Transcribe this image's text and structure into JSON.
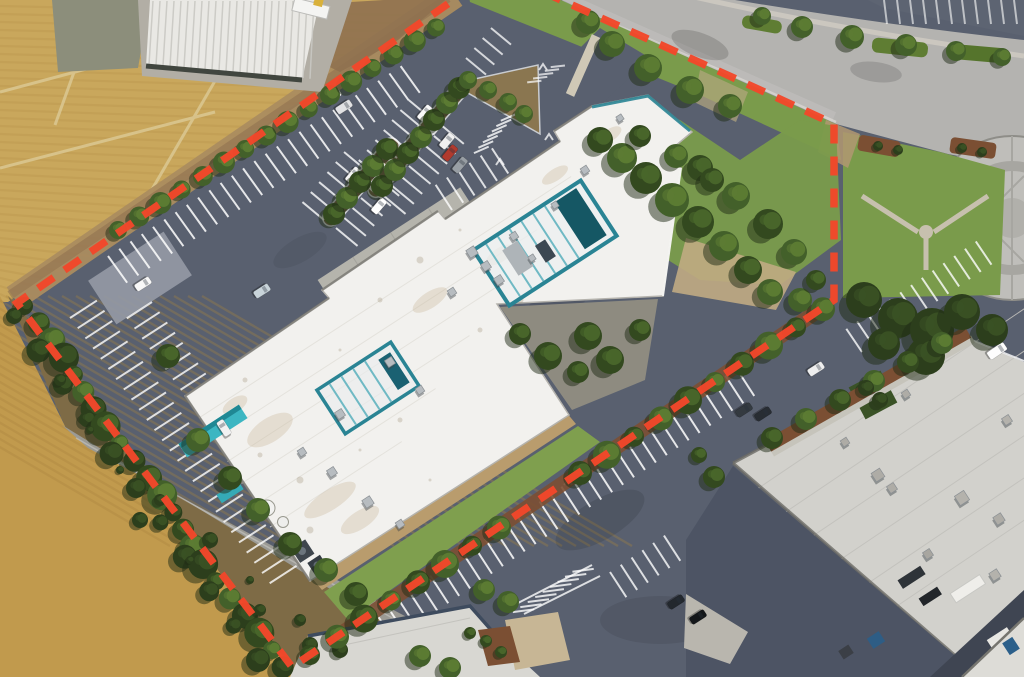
{
  "meta": {
    "image_type": "satellite-aerial-photograph",
    "description": "Overhead aerial view of a suburban commercial office property outlined with a red dashed property-boundary overlay; farm fields to the west, a curving street with landscaped median and circular plaza to the northeast, and a neighboring industrial building to the southeast.",
    "width_px": 1024,
    "height_px": 677,
    "visible_text": "none"
  },
  "annotation": {
    "name": "property-boundary",
    "style": "dashed polygon overlay",
    "color": "#f2472a",
    "dash_length_px": 19,
    "dash_gap_px": 13,
    "stroke_width_px": 7.5
  },
  "palette": {
    "asphalt": "#59606f",
    "asphalt-dark": "#4d5464",
    "road": "#b4b3b0",
    "road-light": "#c3c2bf",
    "rural-road": "#9b9a94",
    "field-gold": "#c9a75c",
    "field-gold-low": "#c19a4d",
    "field-stripe": "#b18c45",
    "scrub": "#7e6b46",
    "dirt": "#ab8c5f",
    "dirt-dark": "#8f7150",
    "lawn": "#7a9b4b",
    "grass-strip": "#7f9f4e",
    "tree-dark": "#2c3e1c",
    "mulch": "#7b4f33",
    "roof-white": "#f2f1ee",
    "roof-gray": "#d2d1cc",
    "roof-industrial": "#e9e8e4",
    "teal": "#2a8494",
    "teal-bright": "#3cb6c2",
    "concrete": "#b5b4ac",
    "sidewalk": "#cdc7b8",
    "stripe-white": "#ffffff",
    "navy-trim": "#3e4b5e"
  },
  "regions": [
    {
      "name": "agricultural-fields",
      "description": "striped golden crop fields and plots west of the site"
    },
    {
      "name": "rural-access-road",
      "description": "narrow gray road crossing the fields bottom-left"
    },
    {
      "name": "industrial-shed",
      "description": "white ribbed-roof building at top-left with trailer"
    },
    {
      "name": "main-parking-lot",
      "description": "blue-gray asphalt lot with white stalls, tree islands and parked cars"
    },
    {
      "name": "main-building-roof",
      "description": "large white membrane roof with teal mechanical screens, teal entry canopy and tree courtyard"
    },
    {
      "name": "boundary-hedge",
      "description": "dense hedge row along the southwest property line"
    },
    {
      "name": "perimeter-tree-rows",
      "description": "street trees along the northwest and southeast stall rows"
    },
    {
      "name": "street",
      "description": "light gray curving public street at top-right with landscaped median"
    },
    {
      "name": "circular-plaza",
      "description": "round concrete cul-de-sac plaza at the right edge"
    },
    {
      "name": "corner-lawn",
      "description": "lawn with Y-shaped paths and dark tree mass inside the NE corner"
    },
    {
      "name": "neighbor-building-roof",
      "description": "warm gray industrial roof southeast of the property"
    },
    {
      "name": "loading-dock",
      "description": "dark service yard with trucks and blue dumpsters"
    },
    {
      "name": "bottom-building",
      "description": "small gray roof with navy trim at bottom-center"
    },
    {
      "name": "property-boundary",
      "description": "red dashed line outlining the parcel"
    }
  ]
}
